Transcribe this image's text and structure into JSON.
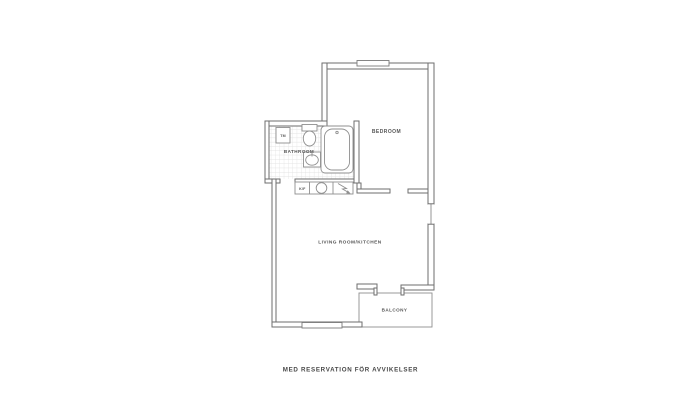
{
  "plan": {
    "labels": {
      "bedroom": "BEDROOM",
      "bathroom": "BATHROOM",
      "living_room": "LIVING ROOM/KITCHEN",
      "balcony": "BALCONY",
      "washing_machine": "TM",
      "fridge_freezer": "K/F"
    },
    "caption": "MED RESERVATION FÖR AVVIKELSER",
    "colors": {
      "wall": "#6e6e6e",
      "fixture_outline": "#8f8f8f",
      "tile_grid": "#dcdcdc",
      "label_text": "#565656",
      "caption_text": "#474747",
      "background": "#ffffff"
    }
  }
}
